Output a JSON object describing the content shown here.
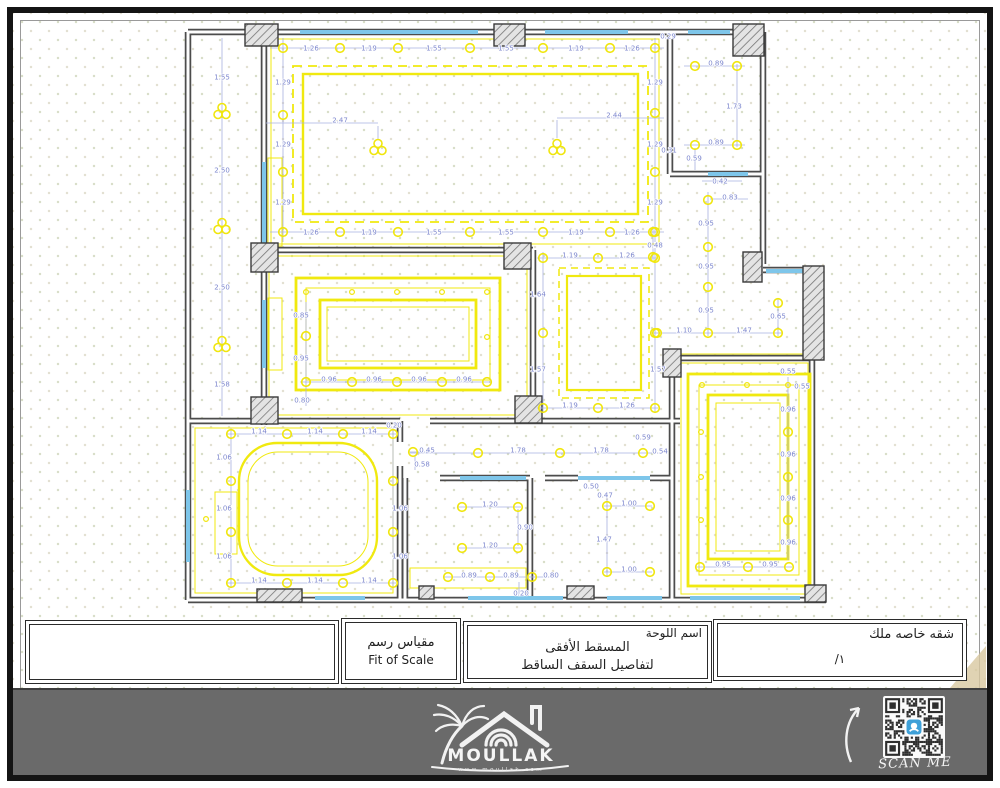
{
  "title_block": {
    "scale_ar": "مقياس رسم",
    "scale_en": "Fit of Scale",
    "sheet_label": "اسم اللوحة",
    "sheet_line1": "المسقط الأفقى",
    "sheet_line2": "لتفاصيل السقف الساقط",
    "owner": "شقه خاصه ملك",
    "sheet_number": "/١"
  },
  "footer": {
    "brand": "MOULLAK",
    "website": "www.moullak.com",
    "scan_me": "SCAN ME"
  },
  "colors": {
    "ceiling_yellow": "#f0e90f",
    "dimension_blue": "#7d87ce",
    "window_blue": "#7ec6ea",
    "wall_gray": "#4c4c4c",
    "footer_gray": "#6a6a6a",
    "qr_accent": "#3ea0d8",
    "corner_tan": "#d8c8a0"
  },
  "plan": {
    "dim_labels": [
      [
        222,
        77,
        "1.55"
      ],
      [
        222,
        170,
        "2.50"
      ],
      [
        222,
        287,
        "2.50"
      ],
      [
        222,
        384,
        "1.58"
      ],
      [
        311,
        48,
        "1.26"
      ],
      [
        369,
        48,
        "1.19"
      ],
      [
        434,
        48,
        "1.55"
      ],
      [
        506,
        48,
        "1.55"
      ],
      [
        576,
        48,
        "1.19"
      ],
      [
        632,
        48,
        "1.26"
      ],
      [
        311,
        232,
        "1.26"
      ],
      [
        369,
        232,
        "1.19"
      ],
      [
        434,
        232,
        "1.55"
      ],
      [
        506,
        232,
        "1.55"
      ],
      [
        576,
        232,
        "1.19"
      ],
      [
        632,
        232,
        "1.26"
      ],
      [
        283,
        82,
        "1.29"
      ],
      [
        283,
        144,
        "1.29"
      ],
      [
        283,
        202,
        "1.29"
      ],
      [
        655,
        82,
        "1.29"
      ],
      [
        655,
        144,
        "1.29"
      ],
      [
        655,
        202,
        "1.29"
      ],
      [
        669,
        150,
        "0.31"
      ],
      [
        668,
        36,
        "0.29"
      ],
      [
        340,
        120,
        "2.47"
      ],
      [
        614,
        115,
        "2.44"
      ],
      [
        716,
        63,
        "0.89"
      ],
      [
        734,
        106,
        "1.73"
      ],
      [
        716,
        142,
        "0.89"
      ],
      [
        694,
        158,
        "0.59"
      ],
      [
        720,
        181,
        "0.42"
      ],
      [
        730,
        197,
        "0.83"
      ],
      [
        706,
        223,
        "0.95"
      ],
      [
        706,
        266,
        "0.95"
      ],
      [
        706,
        310,
        "0.95"
      ],
      [
        684,
        330,
        "1.10"
      ],
      [
        744,
        330,
        "1.47"
      ],
      [
        778,
        316,
        "0.65"
      ],
      [
        655,
        245,
        "0.48"
      ],
      [
        570,
        255,
        "1.19"
      ],
      [
        627,
        255,
        "1.26"
      ],
      [
        538,
        294,
        "1.64"
      ],
      [
        538,
        369,
        "1.57"
      ],
      [
        658,
        369,
        "1.57"
      ],
      [
        570,
        405,
        "1.19"
      ],
      [
        627,
        405,
        "1.26"
      ],
      [
        301,
        315,
        "0.85"
      ],
      [
        301,
        358,
        "0.95"
      ],
      [
        302,
        400,
        "0.80"
      ],
      [
        329,
        379,
        "0.96"
      ],
      [
        374,
        379,
        "0.96"
      ],
      [
        419,
        379,
        "0.96"
      ],
      [
        464,
        379,
        "0.96"
      ],
      [
        259,
        431,
        "1.14"
      ],
      [
        315,
        431,
        "1.14"
      ],
      [
        369,
        431,
        "1.14"
      ],
      [
        394,
        425,
        "0.20"
      ],
      [
        259,
        580,
        "1.14"
      ],
      [
        315,
        580,
        "1.14"
      ],
      [
        369,
        580,
        "1.14"
      ],
      [
        224,
        457,
        "1.06"
      ],
      [
        224,
        508,
        "1.06"
      ],
      [
        224,
        556,
        "1.06"
      ],
      [
        400,
        508,
        "1.06"
      ],
      [
        400,
        556,
        "1.06"
      ],
      [
        427,
        450,
        "0.45"
      ],
      [
        422,
        464,
        "0.58"
      ],
      [
        518,
        450,
        "1.78"
      ],
      [
        601,
        450,
        "1.78"
      ],
      [
        643,
        437,
        "0.59"
      ],
      [
        660,
        451,
        "0.54"
      ],
      [
        490,
        504,
        "1.20"
      ],
      [
        525,
        527,
        "0.90"
      ],
      [
        490,
        545,
        "1.20"
      ],
      [
        469,
        575,
        "0.89"
      ],
      [
        511,
        575,
        "0.89"
      ],
      [
        551,
        575,
        "0.80"
      ],
      [
        521,
        593,
        "0.20"
      ],
      [
        591,
        486,
        "0.50"
      ],
      [
        605,
        495,
        "0.47"
      ],
      [
        629,
        503,
        "1.00"
      ],
      [
        604,
        539,
        "1.47"
      ],
      [
        629,
        569,
        "1.00"
      ],
      [
        788,
        371,
        "0.55"
      ],
      [
        802,
        386,
        "0.55"
      ],
      [
        788,
        409,
        "0.96"
      ],
      [
        788,
        454,
        "0.96"
      ],
      [
        788,
        498,
        "0.96"
      ],
      [
        788,
        542,
        "0.96"
      ],
      [
        723,
        564,
        "0.95"
      ],
      [
        770,
        564,
        "0.95"
      ]
    ],
    "dim_lines": [
      [
        222,
        38,
        222,
        416
      ],
      [
        270,
        48,
        664,
        48
      ],
      [
        270,
        232,
        664,
        232
      ],
      [
        283,
        38,
        283,
        242
      ],
      [
        655,
        38,
        655,
        242
      ],
      [
        266,
        123,
        378,
        123
      ],
      [
        378,
        126,
        378,
        140
      ],
      [
        557,
        118,
        664,
        118
      ],
      [
        557,
        120,
        557,
        138
      ],
      [
        684,
        66,
        745,
        66
      ],
      [
        684,
        145,
        745,
        145
      ],
      [
        737,
        64,
        737,
        147
      ],
      [
        695,
        148,
        695,
        170
      ],
      [
        702,
        181,
        742,
        181
      ],
      [
        708,
        192,
        708,
        336
      ],
      [
        710,
        199,
        748,
        199
      ],
      [
        650,
        333,
        782,
        333
      ],
      [
        778,
        298,
        778,
        336
      ],
      [
        653,
        226,
        653,
        260
      ],
      [
        537,
        258,
        658,
        258
      ],
      [
        537,
        408,
        658,
        408
      ],
      [
        543,
        252,
        543,
        412
      ],
      [
        655,
        248,
        655,
        412
      ],
      [
        306,
        302,
        306,
        406
      ],
      [
        300,
        382,
        490,
        382
      ],
      [
        227,
        434,
        396,
        434
      ],
      [
        227,
        583,
        396,
        583
      ],
      [
        231,
        428,
        231,
        587
      ],
      [
        393,
        428,
        393,
        587
      ],
      [
        409,
        452,
        434,
        452
      ],
      [
        415,
        456,
        415,
        470
      ],
      [
        410,
        453,
        652,
        453
      ],
      [
        457,
        507,
        521,
        507
      ],
      [
        457,
        548,
        521,
        548
      ],
      [
        518,
        509,
        518,
        546
      ],
      [
        443,
        577,
        558,
        577
      ],
      [
        519,
        582,
        519,
        594
      ],
      [
        607,
        498,
        607,
        577
      ],
      [
        604,
        506,
        652,
        506
      ],
      [
        604,
        572,
        652,
        572
      ],
      [
        788,
        377,
        788,
        560
      ],
      [
        696,
        567,
        792,
        567
      ]
    ],
    "spotlights": [
      [
        283,
        48
      ],
      [
        340,
        48
      ],
      [
        398,
        48
      ],
      [
        470,
        48
      ],
      [
        543,
        48
      ],
      [
        610,
        48
      ],
      [
        655,
        48
      ],
      [
        283,
        232
      ],
      [
        340,
        232
      ],
      [
        398,
        232
      ],
      [
        470,
        232
      ],
      [
        543,
        232
      ],
      [
        610,
        232
      ],
      [
        655,
        232
      ],
      [
        283,
        115
      ],
      [
        283,
        172
      ],
      [
        655,
        113
      ],
      [
        655,
        172
      ],
      [
        695,
        66
      ],
      [
        737,
        66
      ],
      [
        695,
        145
      ],
      [
        737,
        145
      ],
      [
        708,
        200
      ],
      [
        708,
        247
      ],
      [
        708,
        287
      ],
      [
        653,
        232
      ],
      [
        653,
        257
      ],
      [
        657,
        333
      ],
      [
        708,
        333
      ],
      [
        778,
        333
      ],
      [
        778,
        303
      ],
      [
        543,
        258
      ],
      [
        598,
        258
      ],
      [
        655,
        258
      ],
      [
        543,
        333
      ],
      [
        655,
        333
      ],
      [
        543,
        408
      ],
      [
        598,
        408
      ],
      [
        655,
        408
      ],
      [
        306,
        336
      ],
      [
        306,
        382
      ],
      [
        352,
        382
      ],
      [
        397,
        382
      ],
      [
        442,
        382
      ],
      [
        487,
        382
      ],
      [
        231,
        434
      ],
      [
        287,
        434
      ],
      [
        343,
        434
      ],
      [
        393,
        434
      ],
      [
        231,
        481
      ],
      [
        231,
        532
      ],
      [
        393,
        481
      ],
      [
        393,
        532
      ],
      [
        231,
        583
      ],
      [
        287,
        583
      ],
      [
        343,
        583
      ],
      [
        393,
        583
      ],
      [
        413,
        452
      ],
      [
        478,
        453
      ],
      [
        560,
        453
      ],
      [
        643,
        453
      ],
      [
        462,
        507
      ],
      [
        518,
        507
      ],
      [
        462,
        548
      ],
      [
        518,
        548
      ],
      [
        448,
        577
      ],
      [
        490,
        577
      ],
      [
        532,
        577
      ],
      [
        607,
        506
      ],
      [
        650,
        506
      ],
      [
        607,
        572
      ],
      [
        650,
        572
      ],
      [
        788,
        432
      ],
      [
        788,
        477
      ],
      [
        788,
        520
      ],
      [
        700,
        567
      ],
      [
        748,
        567
      ],
      [
        789,
        567
      ]
    ],
    "spotlights_small": [
      [
        306,
        292
      ],
      [
        352,
        292
      ],
      [
        397,
        292
      ],
      [
        442,
        292
      ],
      [
        487,
        292
      ],
      [
        487,
        337
      ],
      [
        206,
        519
      ],
      [
        702,
        385
      ],
      [
        747,
        385
      ],
      [
        701,
        432
      ],
      [
        701,
        477
      ],
      [
        701,
        520
      ],
      [
        788,
        385
      ]
    ],
    "chandeliers": [
      [
        378,
        148
      ],
      [
        557,
        148
      ],
      [
        222,
        112
      ],
      [
        222,
        227
      ],
      [
        222,
        345
      ]
    ]
  }
}
